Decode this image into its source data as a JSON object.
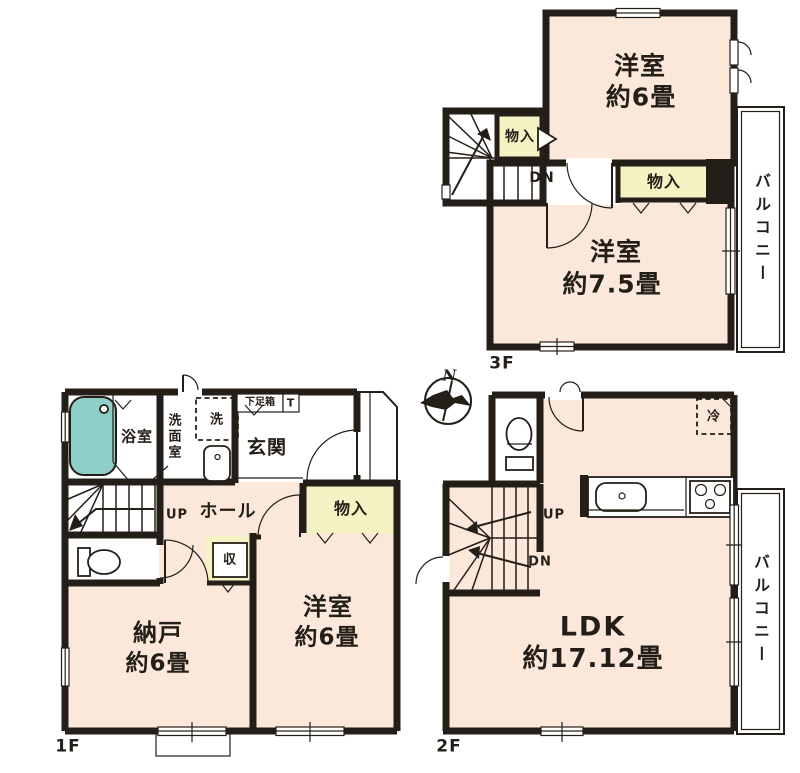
{
  "colors": {
    "wall": "#241e18",
    "room": "#fbe8da",
    "closet": "#f5f2c4",
    "tub": "#8ed0c7",
    "paper": "#ffffff",
    "ink": "#241e18"
  },
  "compass": {
    "north_label": "N"
  },
  "floor3": {
    "label": "3F",
    "room_a_name": "洋室",
    "room_a_size": "約6畳",
    "room_b_name": "洋室",
    "room_b_size": "約7.5畳",
    "closet_a": "物入",
    "closet_b": "物入",
    "stairs_down": "DN",
    "balcony": "バルコニー"
  },
  "floor1": {
    "label": "1F",
    "bath": "浴室",
    "washroom": "洗面室",
    "washer": "洗",
    "shoe_box": "下足箱",
    "shoe_box_t": "T",
    "entrance": "玄関",
    "hall": "ホール",
    "stairs_up": "UP",
    "closet": "物入",
    "storage": "収",
    "storeroom_name": "納戸",
    "storeroom_size": "約6畳",
    "room_name": "洋室",
    "room_size": "約6畳"
  },
  "floor2": {
    "label": "2F",
    "ldk_name": "LDK",
    "ldk_size": "約17.12畳",
    "stairs_up": "UP",
    "stairs_down": "DN",
    "fridge": "冷",
    "balcony": "バルコニー"
  }
}
